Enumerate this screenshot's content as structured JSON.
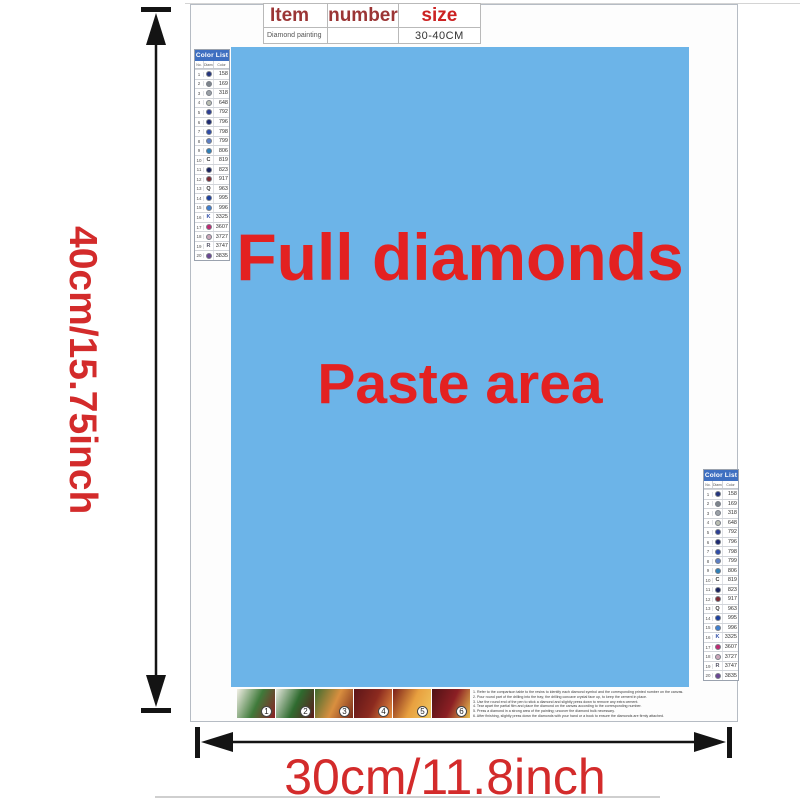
{
  "top_table": {
    "col1_header": "Item",
    "col2_header": "number",
    "col3_header": "size",
    "row_item": "Diamond painting",
    "row_number": "",
    "row_size": "30-40CM"
  },
  "paste_area": {
    "line1": "Full diamonds",
    "line2": "Paste area",
    "bg_color": "#6cb4e8",
    "text_color": "#e32121"
  },
  "dimensions": {
    "height_label": "40cm/15.75inch",
    "width_label": "30cm/11.8inch",
    "label_color": "#d32b2b"
  },
  "color_list": {
    "title": "Color List",
    "columns": [
      "No.",
      "Diamond",
      "Color"
    ],
    "header_bg": "#3e6fc1",
    "rows": [
      {
        "no": "1",
        "symbol": "dot",
        "symbol_color": "#24357e",
        "code": "158"
      },
      {
        "no": "2",
        "symbol": "dot",
        "symbol_color": "#7d858c",
        "code": "169"
      },
      {
        "no": "3",
        "symbol": "dot",
        "symbol_color": "#9aa0a6",
        "code": "318"
      },
      {
        "no": "4",
        "symbol": "dot",
        "symbol_color": "#b9bdb1",
        "code": "648"
      },
      {
        "no": "5",
        "symbol": "dot",
        "symbol_color": "#2c3f94",
        "code": "792"
      },
      {
        "no": "6",
        "symbol": "dot",
        "symbol_color": "#1d2b72",
        "code": "796"
      },
      {
        "no": "7",
        "symbol": "dot",
        "symbol_color": "#2f4da8",
        "code": "798"
      },
      {
        "no": "8",
        "symbol": "dot",
        "symbol_color": "#5c7fc4",
        "code": "799"
      },
      {
        "no": "9",
        "symbol": "dot",
        "symbol_color": "#2e7fb8",
        "code": "806"
      },
      {
        "no": "10",
        "symbol": "letter",
        "letter": "C",
        "symbol_color": "#333333",
        "code": "819"
      },
      {
        "no": "11",
        "symbol": "dot",
        "symbol_color": "#1a2460",
        "code": "823"
      },
      {
        "no": "12",
        "symbol": "dot",
        "symbol_color": "#7c2a33",
        "code": "917"
      },
      {
        "no": "13",
        "symbol": "letter",
        "letter": "Q",
        "symbol_color": "#333333",
        "code": "963"
      },
      {
        "no": "14",
        "symbol": "dot",
        "symbol_color": "#1c3f9e",
        "code": "995"
      },
      {
        "no": "15",
        "symbol": "dot",
        "symbol_color": "#3f7fd0",
        "code": "996"
      },
      {
        "no": "16",
        "symbol": "letter",
        "letter": "K",
        "symbol_color": "#2f4da8",
        "code": "3325"
      },
      {
        "no": "17",
        "symbol": "dot",
        "symbol_color": "#c02a72",
        "code": "3607"
      },
      {
        "no": "18",
        "symbol": "dot",
        "symbol_color": "#caa6b8",
        "code": "3727"
      },
      {
        "no": "19",
        "symbol": "letter",
        "letter": "R",
        "symbol_color": "#555566",
        "code": "3747"
      },
      {
        "no": "20",
        "symbol": "dot",
        "symbol_color": "#6b4794",
        "code": "3835"
      }
    ]
  },
  "steps": {
    "items": [
      {
        "number": "1",
        "gradient_colors": [
          "#f2efe6",
          "#3f7a3a",
          "#8c1f24"
        ]
      },
      {
        "number": "2",
        "gradient_colors": [
          "#e6e8de",
          "#2f6b2f",
          "#5c1a1a"
        ]
      },
      {
        "number": "3",
        "gradient_colors": [
          "#3f6b2f",
          "#d98f3f",
          "#7a2a1a"
        ]
      },
      {
        "number": "4",
        "gradient_colors": [
          "#5c1518",
          "#8c2a1f",
          "#e8903f"
        ]
      },
      {
        "number": "5",
        "gradient_colors": [
          "#7a1f1a",
          "#e8a03f",
          "#f0c860"
        ]
      },
      {
        "number": "6",
        "gradient_colors": [
          "#4f1215",
          "#8c1f24",
          "#e8c050"
        ]
      }
    ]
  },
  "instructions": {
    "lines": [
      "1. Refer to the comparison table to the resins to identify each diamond symbol and the corresponding printed number on the canvas.",
      "2. Pour round part of the drilling into the tray; the drilling concave crystal face up, to keep the cement in place.",
      "3. Use the round end of the pen to stick a diamond and slightly press down to remove any extra cement.",
      "4. Tear apart the partial film and place the diamond on the canvas according to the corresponding number.",
      "5. Press a diamond in a strong area of the painting; uncover the diamond bulk necessary.",
      "6. After finishing, slightly press down the diamonds with your hand or a book to ensure the diamonds are firmly attached."
    ]
  }
}
